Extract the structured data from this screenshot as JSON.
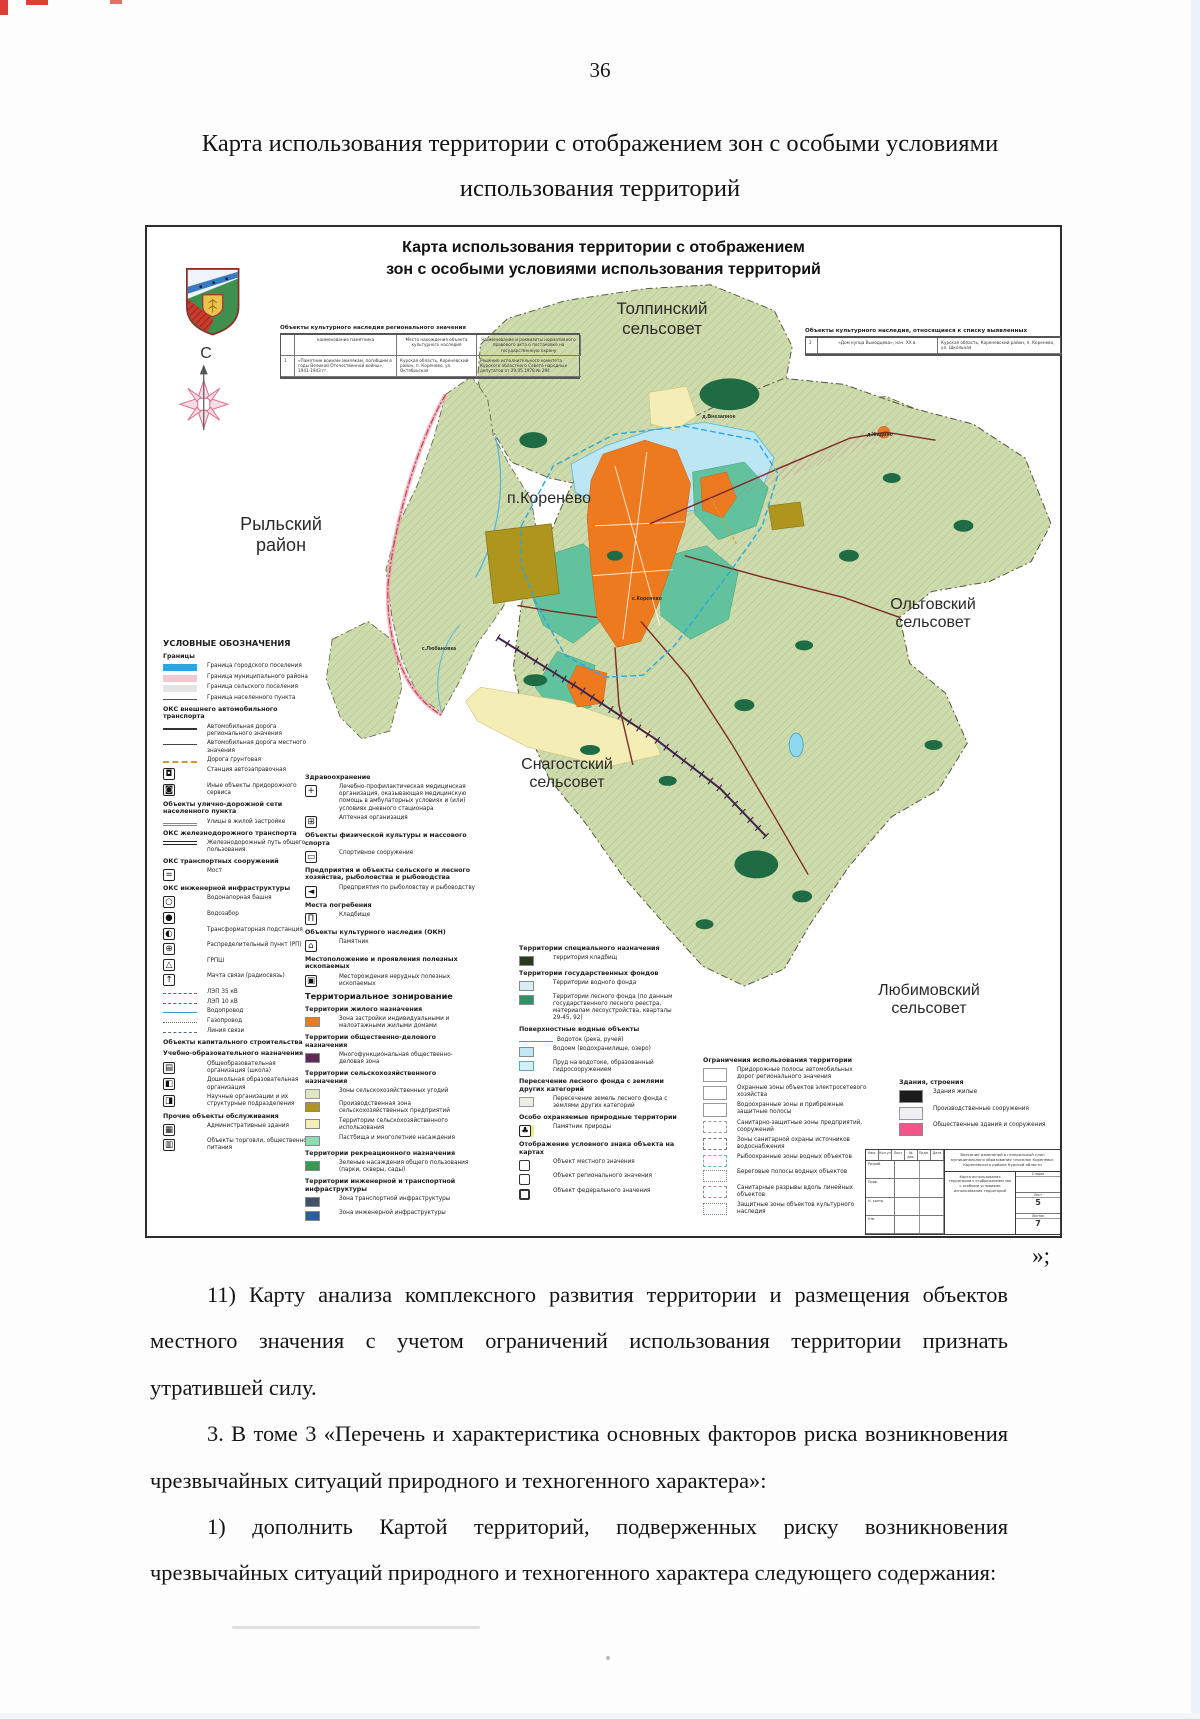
{
  "page": {
    "number": "36",
    "title": "Карта использования территории с отображением зон с особыми условиями использования территорий",
    "closing_mark": "»;",
    "paragraphs": [
      "11) Карту анализа комплексного развития территории и размещения объектов местного значения с учетом ограничений использования территории признать утратившей силу.",
      "3. В томе 3 «Перечень и характеристика основных факторов риска возникновения чрезвычайных ситуаций природного и техногенного характера»:",
      "1) дополнить Картой территорий, подверженных риску возникновения чрезвычайных ситуаций природного и техногенного характера следующего содержания:"
    ]
  },
  "colors": {
    "farmland": "#cedbac",
    "forest": "#1f6b44",
    "water": "#bce6f4",
    "urban_orange": "#ee7a20",
    "teal_zone": "#62c29d",
    "agri_yellow": "#f4eeb6",
    "agri_olive": "#ad951e",
    "boundary_blue": "#2aa7e0",
    "district_pink": "#d05a6e",
    "public_pink": "#f2548c"
  },
  "map": {
    "title_line1": "Карта использования территории с отображением",
    "title_line2": "зон с особыми условиями использования территорий",
    "compass_letter": "С",
    "place_labels": [
      {
        "text": "Толпинский\nсельсовет",
        "x": 515,
        "y": 72,
        "s": 17
      },
      {
        "text": "п.Коренево",
        "x": 402,
        "y": 263,
        "s": 16
      },
      {
        "text": "Рыльский\nрайон",
        "x": 134,
        "y": 287,
        "s": 18
      },
      {
        "text": "Ольговский\nсельсовет",
        "x": 786,
        "y": 369,
        "s": 16
      },
      {
        "text": "Снагостский\nсельсовет",
        "x": 420,
        "y": 529,
        "s": 16
      },
      {
        "text": "Любимовский\nсельсовет",
        "x": 782,
        "y": 755,
        "s": 16
      },
      {
        "text": "д.Внезапное",
        "x": 572,
        "y": 188,
        "s": 5,
        "tiny": true
      },
      {
        "text": "д.Жадино",
        "x": 733,
        "y": 206,
        "s": 5,
        "tiny": true
      },
      {
        "text": "с.Любановка",
        "x": 292,
        "y": 420,
        "s": 5,
        "tiny": true
      },
      {
        "text": "с.Коренево",
        "x": 500,
        "y": 370,
        "s": 5,
        "tiny": true
      }
    ],
    "table_regional": {
      "title": "Объекты культурного наследия регионального значения",
      "col1": "наименование памятника",
      "col2": "Место нахождения объекта культурного наследия",
      "col3": "Наименование и реквизиты нормативного правового акта о постановке на государственную охрану",
      "row_num": "1",
      "cell1": "«Памятник воинам-землякам, погибшим в годы Великой Отечественной войны», 1941-1943 гг.",
      "cell2": "Курская область, Кореневский район, п. Коренево, ул. Октябрьская",
      "cell3": "Решение исполнительного комитета Курского областного Совета народных депутатов от 29.05.1978 № 294"
    },
    "table_detected": {
      "title": "Объекты культурного наследия, относящиеся к списку выявленных",
      "row_num": "2",
      "cell1": "«Дом купца Выходцева», нач. XX в.",
      "cell2": "Курская область, Кореневский район, п. Коренево, ул. Школьная"
    },
    "legend_col1": [
      {
        "h": 1,
        "label": "УСЛОВНЫЕ ОБОЗНАЧЕНИЯ"
      },
      {
        "h": 2,
        "label": "Границы"
      },
      {
        "t": "bar",
        "bg": "#29a7e2",
        "label": "Граница городского поселения"
      },
      {
        "t": "barh",
        "bg": "#f3c9d2",
        "c": "#c43a4b",
        "label": "Граница муниципального района"
      },
      {
        "t": "barh",
        "bg": "#e4e4e4",
        "c": "#9a9a9a",
        "label": "Граница сельского поселения"
      },
      {
        "t": "line",
        "c": "#555",
        "bs": "solid",
        "css": "border-top-width:1px",
        "label": "Граница населенного пункта"
      },
      {
        "h": 2,
        "label": "ОКС внешнего автомобильного транспорта"
      },
      {
        "t": "line",
        "c": "#333",
        "bs": "solid",
        "label": "Автомобильная дорога регионального значения"
      },
      {
        "t": "line",
        "c": "#444",
        "bs": "solid",
        "css": "border-top-width:1px",
        "label": "Автомобильная дорога местного значения"
      },
      {
        "t": "line",
        "c": "#cf9a2c",
        "bs": "dashed",
        "label": "Дорога грунтовая"
      },
      {
        "t": "icon",
        "g": "◘",
        "label": "Станция автозаправочная"
      },
      {
        "t": "icon",
        "g": "◙",
        "label": "Иные объекты придорожного сервиса"
      },
      {
        "h": 2,
        "label": "Объекты улично-дорожной сети населенного пункта"
      },
      {
        "t": "line",
        "c": "#888",
        "bs": "solid",
        "css": "border-top-width:1px;border-bottom:1px solid #888;height:3px",
        "label": "Улицы в жилой застройке"
      },
      {
        "h": 2,
        "label": "ОКС железнодорожного транспорта"
      },
      {
        "t": "dline",
        "label": "Железнодорожный путь общего пользования"
      },
      {
        "h": 2,
        "label": "ОКС транспортных сооружений"
      },
      {
        "t": "icon",
        "g": "=",
        "label": "Мост"
      },
      {
        "h": 2,
        "label": "ОКС инженерной инфраструктуры"
      },
      {
        "t": "icon",
        "g": "○",
        "label": "Водонапорная башня"
      },
      {
        "t": "icon",
        "g": "●",
        "label": "Водозабор"
      },
      {
        "t": "icon",
        "g": "◐",
        "label": "Трансформаторная подстанция"
      },
      {
        "t": "icon",
        "g": "⊕",
        "label": "Распределительный пункт (РП)"
      },
      {
        "t": "icon",
        "g": "△",
        "label": "ГРПШ"
      },
      {
        "t": "icon",
        "g": "↑",
        "label": "Мачта связи (радиосвязь)"
      },
      {
        "t": "line",
        "c": "#b3405e",
        "bs": "dashed",
        "css": "border-top-width:1px",
        "label": "ЛЭП 35 кВ"
      },
      {
        "t": "line",
        "c": "#a23a8a",
        "bs": "dashed",
        "css": "border-top-width:1px",
        "label": "ЛЭП 10 кВ"
      },
      {
        "t": "line",
        "c": "#3a9fc8",
        "bs": "solid",
        "css": "border-top-width:1px",
        "label": "Водопровод"
      },
      {
        "t": "line",
        "c": "#666",
        "bs": "dotted",
        "css": "border-top-width:1.5px",
        "label": "Газопровод"
      },
      {
        "t": "line",
        "c": "#5b6a9e",
        "bs": "dashed",
        "css": "border-top-width:1px",
        "label": "Линия связи"
      },
      {
        "h": 2,
        "label": "Объекты капитального строительства"
      },
      {
        "h": 2,
        "label": "Учебно-образовательного назначения"
      },
      {
        "t": "icon",
        "g": "▤",
        "label": "Общеобразовательная организация (школа)"
      },
      {
        "t": "icon",
        "g": "◧",
        "label": "Дошкольная образовательная организация"
      },
      {
        "t": "icon",
        "g": "◨",
        "label": "Научные организации и их структурные подразделения"
      },
      {
        "h": 2,
        "label": "Прочие объекты обслуживания"
      },
      {
        "t": "icon",
        "g": "▦",
        "label": "Административные здания"
      },
      {
        "t": "icon",
        "g": "▥",
        "label": "Объекты торговли, общественного питания"
      }
    ],
    "legend_col2": [
      {
        "h": 2,
        "label": "Здравоохранение"
      },
      {
        "t": "icon",
        "g": "+",
        "label": "Лечебно-профилактическая медицинская организация, оказывающая медицинскую помощь в амбулаторных условиях и (или) условиях дневного стационара"
      },
      {
        "t": "icon",
        "g": "⊞",
        "label": "Аптечная организация"
      },
      {
        "h": 2,
        "label": "Объекты физической культуры и массового спорта"
      },
      {
        "t": "icon",
        "g": "▭",
        "label": "Спортивное сооружение"
      },
      {
        "h": 2,
        "label": "Предприятия и объекты сельского и лесного хозяйства, рыболовства и рыбоводства"
      },
      {
        "t": "icon",
        "g": "◄",
        "label": "Предприятия по рыболовству и рыбоводству"
      },
      {
        "h": 2,
        "label": "Места погребения"
      },
      {
        "t": "icon",
        "g": "Π",
        "label": "Кладбище"
      },
      {
        "h": 2,
        "label": "Объекты культурного наследия (ОКН)"
      },
      {
        "t": "icon",
        "g": "⌂",
        "label": "Памятник"
      },
      {
        "h": 2,
        "label": "Местоположение и проявления полезных ископаемых"
      },
      {
        "t": "icon",
        "g": "▣",
        "label": "Месторождения нерудных полезных ископаемых"
      },
      {
        "h": 1,
        "label": "Территориальное зонирование"
      },
      {
        "h": 2,
        "label": "Территории жилого назначения"
      },
      {
        "t": "box",
        "bg": "#ee7a20",
        "label": "Зона застройки индивидуальными и малоэтажными жилыми домами"
      },
      {
        "h": 2,
        "label": "Территории общественно-делового назначения"
      },
      {
        "t": "box",
        "bg": "#5e2a58",
        "label": "Многофункциональная общественно-деловая зона"
      },
      {
        "h": 2,
        "label": "Территории сельскохозяйственного назначения"
      },
      {
        "t": "boxh",
        "bg": "#dde7c2",
        "c": "#a9bd85",
        "label": "Зоны сельскохозяйственных угодий"
      },
      {
        "t": "box",
        "bg": "#ad951e",
        "label": "Производственная зона сельскохозяйственных предприятий"
      },
      {
        "t": "box",
        "bg": "#f4eeb6",
        "label": "Территории сельскохозяйственного использования"
      },
      {
        "t": "box",
        "bg": "#8fdcb4",
        "label": "Пастбища и многолетние насаждения"
      },
      {
        "h": 2,
        "label": "Территории рекреационного назначения"
      },
      {
        "t": "box",
        "bg": "#2f9e52",
        "label": "Зеленые насаждения общего пользования (парки, скверы, сады)"
      },
      {
        "h": 2,
        "label": "Территории инженерной и транспортной инфраструктуры"
      },
      {
        "t": "box",
        "bg": "#43506b",
        "label": "Зона транспортной инфраструктуры"
      },
      {
        "t": "box",
        "bg": "#2a5f9e",
        "label": "Зона инженерной инфраструктуры"
      }
    ],
    "legend_col3": [
      {
        "h": 2,
        "label": "Территории специального назначения"
      },
      {
        "t": "box",
        "bg": "#2a3a22",
        "label": "территория кладбищ"
      },
      {
        "h": 2,
        "label": "Территории государственных фондов"
      },
      {
        "t": "box",
        "bg": "#d6eff4",
        "label": "Территории водного фонда"
      },
      {
        "t": "box",
        "bg": "#2e9467",
        "label": "Территории лесного фонда (по данным государственного лесного реестра, материалам лесоустройства, кварталы 29-45, 92)"
      },
      {
        "h": 2,
        "label": "Поверхностные водные объекты"
      },
      {
        "t": "line",
        "c": "#2aa7e0",
        "bs": "solid",
        "css": "border-top-width:1.5px",
        "label": "Водоток (река, ручей)"
      },
      {
        "t": "box",
        "bg": "#bfe9f2",
        "label": "Водоем (водохранилище, озеро)"
      },
      {
        "t": "box",
        "bg": "#d6eff4",
        "css": "border:1px solid #59a9c4",
        "label": "Пруд на водотоке, образованный гидросооружением"
      },
      {
        "h": 2,
        "label": "Пересечение лесного фонда с землями других категорий"
      },
      {
        "t": "boxh",
        "bg": "#e9efe3",
        "c": "#9fae9b",
        "label": "Пересечение земель лесного фонда с землями других категорий"
      },
      {
        "h": 2,
        "label": "Особо охраняемые природные территории"
      },
      {
        "t": "icon",
        "g": "♣",
        "css": "box-shadow:3px 0 0 0 #ecec8a",
        "label": "Памятник природы"
      },
      {
        "h": 2,
        "label": "Отображение условного знака объекта на картах"
      },
      {
        "t": "sq",
        "label": "Объект местного значения"
      },
      {
        "t": "sq",
        "css": "border-width:1.5px",
        "label": "Объект регионального значения"
      },
      {
        "t": "sq",
        "css": "border-width:2.5px",
        "label": "Объект федерального значения"
      }
    ],
    "legend_col4": [
      {
        "h": 2,
        "label": "Ограничения использования территории"
      },
      {
        "t": "boxh",
        "bg": "#ffffff",
        "c": "#b2407a",
        "css": "width:24px;height:14px",
        "label": "Придорожные полосы автомобильных дорог регионального значения"
      },
      {
        "t": "boxh",
        "bg": "#ffffff",
        "c": "#8f4f9f",
        "css": "width:24px;height:14px",
        "label": "Охранные зоны объектов электросетевого хозяйства"
      },
      {
        "t": "boxh",
        "bg": "#ffffff",
        "c": "#79c4e2",
        "css": "width:24px;height:14px",
        "label": "Водоохранные зоны и прибрежные защитные полосы"
      },
      {
        "t": "sqd",
        "css": "width:24px;height:12px;border-color:#999",
        "label": "Санитарно-защитные зоны предприятий, сооружений"
      },
      {
        "t": "sqd",
        "css": "width:24px;height:12px;border-color:#778",
        "label": "Зоны санитарной охраны источников водоснабжения"
      },
      {
        "t": "sqd",
        "css": "width:24px;height:12px;border-color:#69b0cf",
        "label": "Рыбоохранные зоны водных объектов"
      },
      {
        "t": "sqd",
        "css": "width:24px;height:12px;border-style:dotted;border-color:#888",
        "label": "Береговые полосы водных объектов"
      },
      {
        "t": "sqd",
        "css": "width:24px;height:12px;border-color:#a88",
        "label": "Санитарные разрывы вдоль линейных объектов"
      },
      {
        "t": "sqd",
        "css": "width:24px;height:12px;border-style:dotted;border-color:#789",
        "label": "Защитные зоны объектов культурного наследия"
      }
    ],
    "legend_col5": [
      {
        "h": 2,
        "label": "Здания, строения"
      },
      {
        "t": "box",
        "bg": "#1c1c1c",
        "css": "width:24px;height:13px",
        "label": "Здания жилые"
      },
      {
        "t": "boxh",
        "bg": "#efeff4",
        "c": "#8d82a0",
        "css": "width:24px;height:13px",
        "label": "Производственные сооружения"
      },
      {
        "t": "box",
        "bg": "#f2548c",
        "css": "width:24px;height:13px",
        "label": "Общественные здания и сооружения"
      }
    ],
    "stamp": {
      "header_cols": [
        "Изм.",
        "Кол.уч",
        "Лист",
        "№ док.",
        "Подп.",
        "Дата"
      ],
      "rows": [
        "Разраб.",
        "Пров.",
        "Н. контр.",
        "Утв."
      ],
      "title": "Внесение изменений в генеральный план муниципального образования «поселок Коренево» Кореневского района Курской области",
      "doc": "Карта использования территории с отображением зон с особыми условиями использования территорий",
      "stage_label": "Стадия",
      "sheet_label": "Лист",
      "sheets_label": "Листов",
      "sheet": "5",
      "sheets": "7"
    }
  }
}
